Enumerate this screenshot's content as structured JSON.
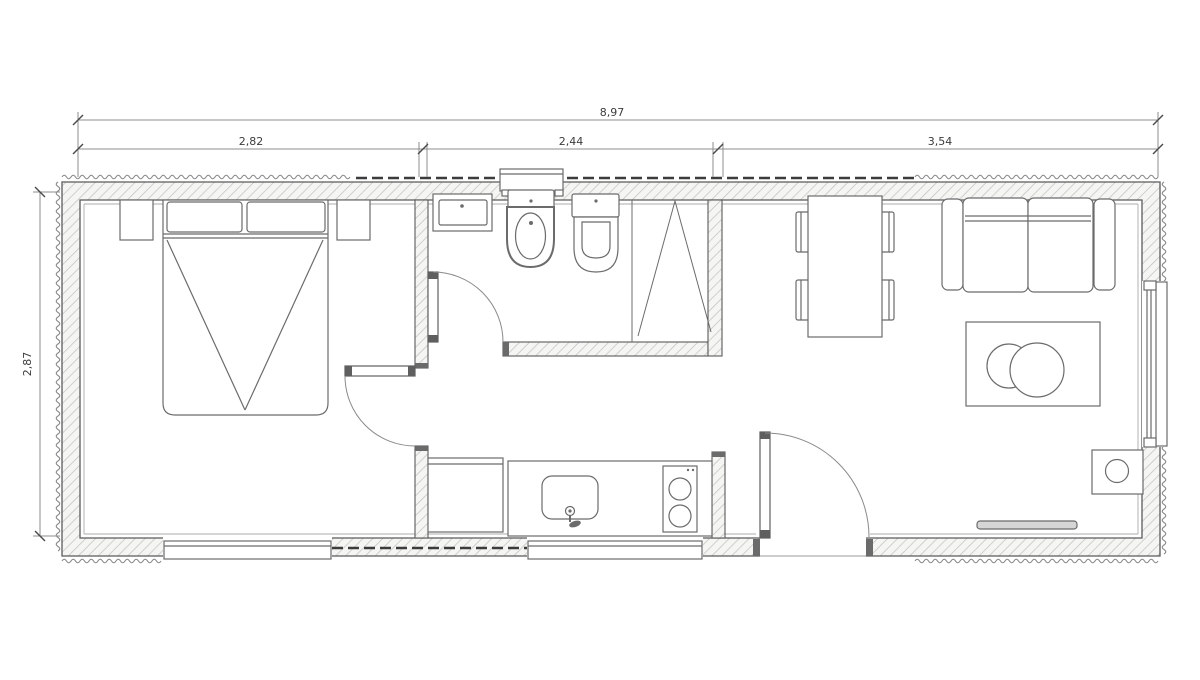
{
  "title": "container-home-floor-plan",
  "dims": {
    "overall": "8,97",
    "seg1": "2,82",
    "seg2": "2,44",
    "seg3": "3,54",
    "height": "2,87"
  },
  "colors": {
    "wall_line": "#5a5a5a",
    "furniture_line": "#6b6b6b",
    "hatch_fill": "#f5f5f3",
    "hatch_line": "#c3c3c0",
    "corrugation": "#8a8a8a",
    "dash_band": "#3c3c3c",
    "dim_line": "#8c8c8c",
    "background": "#ffffff"
  },
  "rooms": {
    "bedroom": {
      "furniture": [
        "double-bed",
        "pillow-left",
        "pillow-right",
        "nightstand-left",
        "nightstand-right"
      ]
    },
    "bathroom": {
      "fixtures": [
        "wash-basin",
        "bidet",
        "toilet",
        "shower-folding-door",
        "bathroom-window"
      ]
    },
    "kitchen": {
      "fixtures": [
        "fridge-cabinet",
        "counter",
        "kitchen-sink",
        "faucet",
        "two-burner-cooktop"
      ]
    },
    "living": {
      "furniture": [
        "dining-table",
        "chair-x4",
        "two-seat-sofa",
        "coffee-table",
        "wall-shelf",
        "water-heater"
      ]
    }
  },
  "openings": [
    "bedroom-door",
    "bathroom-door",
    "entry-door",
    "window-top",
    "window-bottom-bedroom",
    "window-bottom-kitchen",
    "window-right"
  ]
}
